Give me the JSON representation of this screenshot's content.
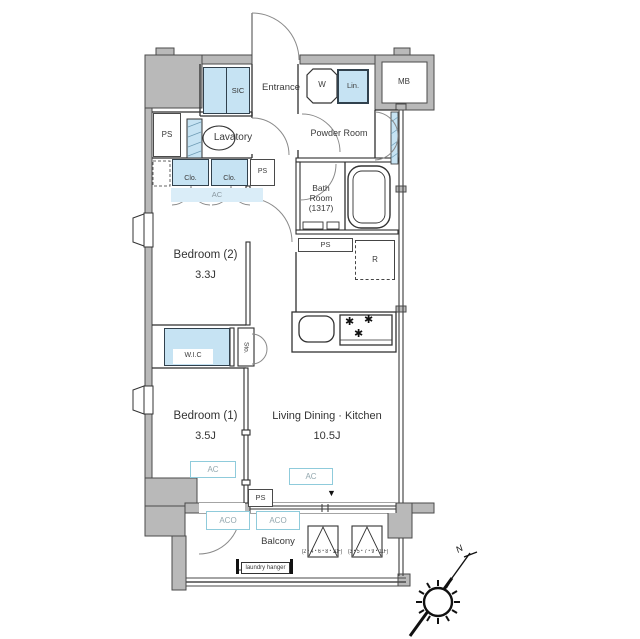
{
  "floorplan": {
    "rooms": {
      "entrance": {
        "name": "Entrance"
      },
      "lavatory": {
        "name": "Lavatory"
      },
      "powder_room": {
        "name": "Powder Room"
      },
      "bath_room": {
        "name": "Bath Room",
        "size": "(1317)"
      },
      "bedroom2": {
        "name": "Bedroom (2)",
        "size": "3.3J"
      },
      "bedroom1": {
        "name": "Bedroom (1)",
        "size": "3.5J"
      },
      "ldk": {
        "name": "Living Dining · Kitchen",
        "size": "10.5J"
      },
      "balcony": {
        "name": "Balcony"
      }
    },
    "closets": {
      "sic": "SIC",
      "linen": "Lin.",
      "closet1": "Clo.",
      "closet2": "Clo.",
      "wic": "W.I.C",
      "storage": "Sto."
    },
    "equipment": {
      "washer": "W",
      "meter_box": "MB",
      "refrigerator": "R",
      "pipe_space": "PS",
      "ac": "AC",
      "ac_outdoor": "ACO"
    },
    "balcony_items": {
      "laundry_hanger": "laundry hanger",
      "hatch1_floors": "(2・4・6・8・10F)",
      "hatch2_floors": "(3・5・7・9・11F)"
    },
    "compass": {
      "north_label": "N"
    },
    "icons": {
      "stove_burner": "✱",
      "window_marker": "▼"
    },
    "colors": {
      "wall_gray": "#b9b9b9",
      "storage_blue": "#c6e3f3",
      "ac_teal": "#8fcbdb"
    }
  }
}
